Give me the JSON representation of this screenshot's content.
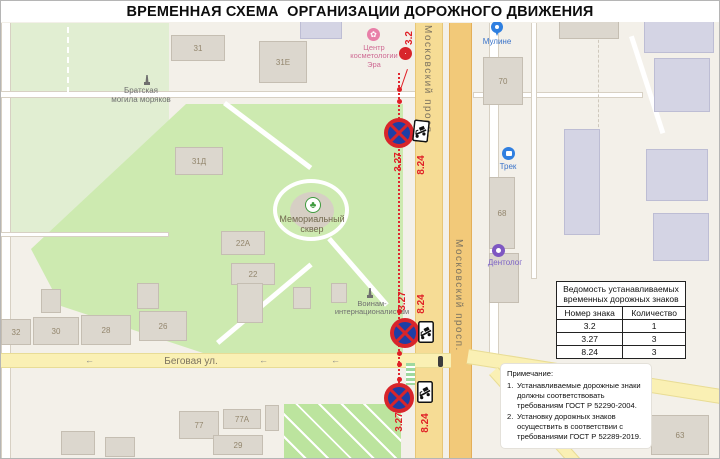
{
  "title": "ВРЕМЕННАЯ СХЕМА  ОРГАНИЗАЦИИ ДОРОЖНОГО ДВИЖЕНИЯ",
  "palette": {
    "sign_red": "#d8252b",
    "sign_blue": "#1e3ea6",
    "route_red": "#e01f26",
    "park_green": "#cdeab0",
    "road_orange": "#f2c979",
    "road_yellow": "#faf0b4"
  },
  "map": {
    "streets": {
      "moskovsky": "Московский просп.",
      "begovaya": "Беговая ул."
    },
    "direction_arrow": "←",
    "pois": {
      "bratskaya_line1": "Братская",
      "bratskaya_line2": "могила моряков",
      "cosmetology_line1": "Центр",
      "cosmetology_line2": "косметологии",
      "cosmetology_line3": "Эра",
      "memorial_line1": "Мемориальный",
      "memorial_line2": "сквер",
      "voinam_line1": "Воинам-",
      "voinam_line2": "интернационалистам",
      "muline": "Мулине",
      "trek": "Трек",
      "dentolog": "Дентолог"
    },
    "buildings": {
      "b31": "31",
      "b31e": "31Е",
      "b31d": "31Д",
      "b22a": "22А",
      "b22": "22",
      "b32": "32",
      "b30": "30",
      "b28": "28",
      "b26": "26",
      "b77": "77",
      "b77a": "77А",
      "b29": "29",
      "b70": "70",
      "b68": "68",
      "b63": "63"
    },
    "sign_labels": {
      "s32": "3.2",
      "s327": "3.27",
      "s824": "8.24"
    }
  },
  "table": {
    "title_line1": "Ведомость устанавливаемых",
    "title_line2": "временных дорожных знаков",
    "col_sign": "Номер знака",
    "col_qty": "Количество",
    "rows": [
      {
        "sign": "3.2",
        "qty": "1"
      },
      {
        "sign": "3.27",
        "qty": "3"
      },
      {
        "sign": "8.24",
        "qty": "3"
      }
    ]
  },
  "notes": {
    "heading": "Примечание:",
    "items": [
      {
        "num": "1.",
        "text": "Устанавливаемые дорожные знаки должны соответствовать требованиям ГОСТ Р 52290-2004."
      },
      {
        "num": "2.",
        "text": "Установку дорожных знаков осуществить в соответствии с требованиями ГОСТ Р 52289-2019."
      }
    ]
  }
}
